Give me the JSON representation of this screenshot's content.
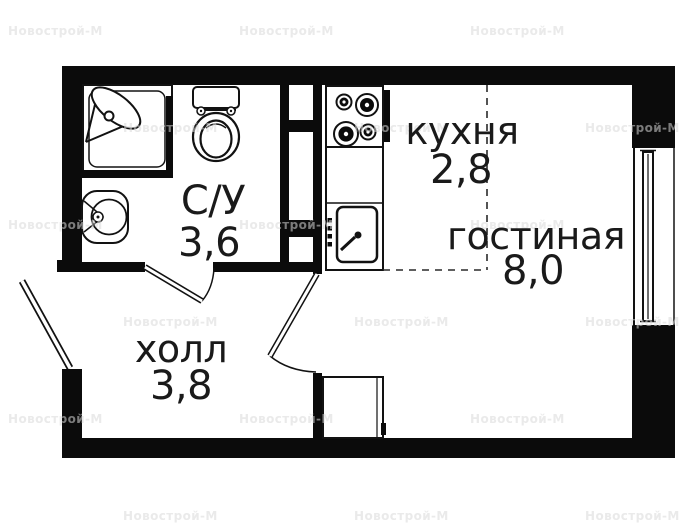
{
  "rooms": [
    {
      "id": "bathroom",
      "name": "С/У",
      "area": "3,6"
    },
    {
      "id": "kitchen",
      "name": "кухня",
      "area": "2,8"
    },
    {
      "id": "living",
      "name": "гостиная",
      "area": "8,0"
    },
    {
      "id": "hall",
      "name": "холл",
      "area": "3,8"
    }
  ],
  "watermark": {
    "text": "Новострой-М",
    "color": "#d9d9d9",
    "positions": [
      [
        8,
        24
      ],
      [
        239,
        24
      ],
      [
        470,
        24
      ],
      [
        123,
        121
      ],
      [
        354,
        121
      ],
      [
        585,
        121
      ],
      [
        8,
        218
      ],
      [
        239,
        218
      ],
      [
        470,
        218
      ],
      [
        123,
        315
      ],
      [
        354,
        315
      ],
      [
        585,
        315
      ],
      [
        8,
        412
      ],
      [
        239,
        412
      ],
      [
        470,
        412
      ],
      [
        123,
        509
      ],
      [
        354,
        509
      ],
      [
        585,
        509
      ]
    ]
  },
  "colors": {
    "wall": "#0b0b0b",
    "line": "#121212",
    "dashed_line": "#2a2a2a",
    "text": "#1a1a1a",
    "background": "#ffffff"
  },
  "fixtures": [
    "shower",
    "toilet",
    "bathroom-sink",
    "vent-shaft",
    "stove",
    "kitchen-sink",
    "window",
    "wardrobe",
    "entrance-door",
    "bathroom-door",
    "living-room-door"
  ]
}
